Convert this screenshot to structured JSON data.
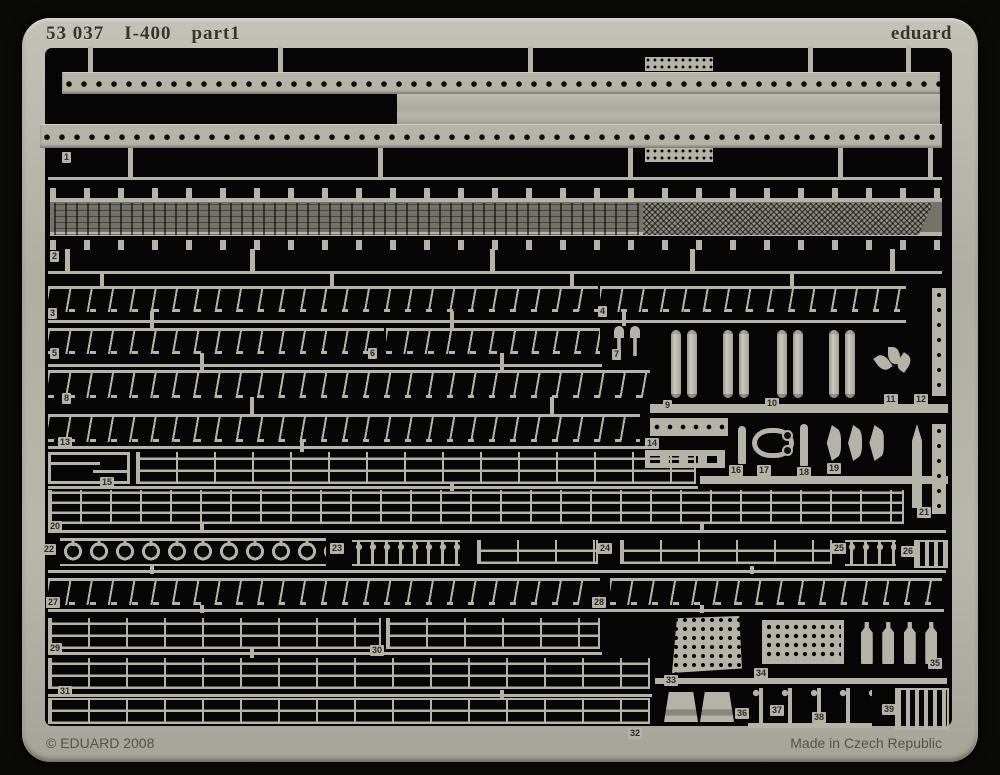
{
  "sheet": {
    "title_catalog": "53 037",
    "title_model": "I-400",
    "title_part": "part1",
    "brand": "eduard",
    "copyright": "© EDUARD 2008",
    "made_in": "Made in Czech Republic"
  },
  "colors": {
    "metal": "#b3b3a8",
    "background": "#060606",
    "deck": "#73736b",
    "label_text": "#2a2a25"
  },
  "part_labels": [
    {
      "n": "1",
      "x": 62,
      "y": 152
    },
    {
      "n": "2",
      "x": 50,
      "y": 251
    },
    {
      "n": "3",
      "x": 48,
      "y": 308
    },
    {
      "n": "4",
      "x": 598,
      "y": 306
    },
    {
      "n": "5",
      "x": 50,
      "y": 348
    },
    {
      "n": "6",
      "x": 368,
      "y": 348
    },
    {
      "n": "7",
      "x": 612,
      "y": 349
    },
    {
      "n": "8",
      "x": 62,
      "y": 393
    },
    {
      "n": "9",
      "x": 663,
      "y": 400
    },
    {
      "n": "10",
      "x": 765,
      "y": 398
    },
    {
      "n": "11",
      "x": 884,
      "y": 394
    },
    {
      "n": "12",
      "x": 914,
      "y": 394
    },
    {
      "n": "13",
      "x": 58,
      "y": 437
    },
    {
      "n": "14",
      "x": 645,
      "y": 438
    },
    {
      "n": "15",
      "x": 100,
      "y": 477
    },
    {
      "n": "16",
      "x": 729,
      "y": 465
    },
    {
      "n": "17",
      "x": 757,
      "y": 465
    },
    {
      "n": "18",
      "x": 797,
      "y": 467
    },
    {
      "n": "19",
      "x": 827,
      "y": 463
    },
    {
      "n": "20",
      "x": 48,
      "y": 521
    },
    {
      "n": "21",
      "x": 917,
      "y": 507
    },
    {
      "n": "22",
      "x": 42,
      "y": 544
    },
    {
      "n": "23",
      "x": 330,
      "y": 543
    },
    {
      "n": "24",
      "x": 598,
      "y": 543
    },
    {
      "n": "25",
      "x": 832,
      "y": 543
    },
    {
      "n": "26",
      "x": 901,
      "y": 546
    },
    {
      "n": "27",
      "x": 46,
      "y": 597
    },
    {
      "n": "28",
      "x": 592,
      "y": 597
    },
    {
      "n": "29",
      "x": 48,
      "y": 643
    },
    {
      "n": "30",
      "x": 370,
      "y": 645
    },
    {
      "n": "31",
      "x": 58,
      "y": 686
    },
    {
      "n": "32",
      "x": 628,
      "y": 728
    },
    {
      "n": "33",
      "x": 664,
      "y": 675
    },
    {
      "n": "34",
      "x": 754,
      "y": 668
    },
    {
      "n": "35",
      "x": 928,
      "y": 658
    },
    {
      "n": "36",
      "x": 735,
      "y": 708
    },
    {
      "n": "37",
      "x": 770,
      "y": 705
    },
    {
      "n": "38",
      "x": 812,
      "y": 712
    },
    {
      "n": "39",
      "x": 882,
      "y": 704
    }
  ],
  "strips": [
    {
      "t": "dotted",
      "x": 62,
      "y": 72,
      "w": 878,
      "h": 22,
      "n": "1"
    },
    {
      "t": "slab",
      "x": 397,
      "y": 94,
      "w": 543,
      "h": 31,
      "n": "1"
    },
    {
      "t": "dotted",
      "x": 40,
      "y": 124,
      "w": 902,
      "h": 24,
      "n": "1"
    },
    {
      "t": "minigrid",
      "x": 645,
      "y": 57,
      "w": 68,
      "h": 14,
      "n": "1"
    },
    {
      "t": "minigrid",
      "x": 645,
      "y": 148,
      "w": 68,
      "h": 14,
      "n": "1"
    },
    {
      "t": "deck",
      "x": 50,
      "y": 188,
      "w": 892,
      "h": 62,
      "n": "2"
    },
    {
      "t": "railing",
      "x": 48,
      "y": 286,
      "w": 550,
      "h": 26,
      "n": "3"
    },
    {
      "t": "railing",
      "x": 600,
      "y": 286,
      "w": 306,
      "h": 26,
      "n": "4"
    },
    {
      "t": "railing",
      "x": 48,
      "y": 328,
      "w": 336,
      "h": 26,
      "n": "5"
    },
    {
      "t": "railing",
      "x": 386,
      "y": 328,
      "w": 214,
      "h": 26,
      "n": "6"
    },
    {
      "t": "pins2",
      "x": 610,
      "y": 326,
      "w": 34,
      "h": 30,
      "n": "7"
    },
    {
      "t": "railing",
      "x": 48,
      "y": 370,
      "w": 602,
      "h": 28,
      "n": "8"
    },
    {
      "t": "torppair",
      "x": 664,
      "y": 328,
      "w": 40,
      "h": 72,
      "n": "9"
    },
    {
      "t": "torppair",
      "x": 716,
      "y": 328,
      "w": 40,
      "h": 72,
      "n": "9"
    },
    {
      "t": "torppair",
      "x": 770,
      "y": 328,
      "w": 40,
      "h": 72,
      "n": "10"
    },
    {
      "t": "torppair",
      "x": 822,
      "y": 328,
      "w": 40,
      "h": 72,
      "n": "10"
    },
    {
      "t": "sprig",
      "x": 876,
      "y": 346,
      "w": 36,
      "h": 46,
      "n": "11"
    },
    {
      "t": "vstrip",
      "x": 932,
      "y": 288,
      "w": 14,
      "h": 108,
      "n": "12"
    },
    {
      "t": "railing",
      "x": 48,
      "y": 414,
      "w": 592,
      "h": 28,
      "n": "13"
    },
    {
      "t": "beadstrip",
      "x": 650,
      "y": 418,
      "w": 78,
      "h": 18,
      "n": "14"
    },
    {
      "t": "slotstrip",
      "x": 645,
      "y": 450,
      "w": 80,
      "h": 18,
      "n": "14"
    },
    {
      "t": "bracket15",
      "x": 48,
      "y": 452,
      "w": 82,
      "h": 32,
      "n": "15"
    },
    {
      "t": "ladder2",
      "x": 136,
      "y": 452,
      "w": 560,
      "h": 32,
      "n": "15"
    },
    {
      "t": "pin",
      "x": 738,
      "y": 426,
      "w": 8,
      "h": 38,
      "n": "16"
    },
    {
      "t": "horseshoe",
      "x": 752,
      "y": 428,
      "w": 42,
      "h": 30,
      "n": "17"
    },
    {
      "t": "pin",
      "x": 800,
      "y": 424,
      "w": 8,
      "h": 42,
      "n": "18"
    },
    {
      "t": "crescents",
      "x": 820,
      "y": 424,
      "w": 68,
      "h": 38,
      "n": "19"
    },
    {
      "t": "ladder3",
      "x": 48,
      "y": 490,
      "w": 856,
      "h": 34,
      "n": "20"
    },
    {
      "t": "blade",
      "x": 912,
      "y": 424,
      "w": 10,
      "h": 84,
      "n": "21"
    },
    {
      "t": "vstrip",
      "x": 932,
      "y": 424,
      "w": 14,
      "h": 90,
      "n": "21"
    },
    {
      "t": "goblets",
      "x": 60,
      "y": 538,
      "w": 266,
      "h": 28,
      "n": "22"
    },
    {
      "t": "beadposts",
      "x": 352,
      "y": 540,
      "w": 108,
      "h": 26,
      "n": "23"
    },
    {
      "t": "ladder2",
      "x": 477,
      "y": 540,
      "w": 121,
      "h": 24,
      "n": "24"
    },
    {
      "t": "ladder2",
      "x": 620,
      "y": 540,
      "w": 212,
      "h": 24,
      "n": "24"
    },
    {
      "t": "beadposts",
      "x": 845,
      "y": 540,
      "w": 51,
      "h": 26,
      "n": "25"
    },
    {
      "t": "brackets",
      "x": 914,
      "y": 540,
      "w": 34,
      "h": 28,
      "n": "26"
    },
    {
      "t": "railing",
      "x": 48,
      "y": 578,
      "w": 552,
      "h": 27,
      "n": "27"
    },
    {
      "t": "railing",
      "x": 610,
      "y": 578,
      "w": 332,
      "h": 27,
      "n": "28"
    },
    {
      "t": "ladder2",
      "x": 48,
      "y": 618,
      "w": 333,
      "h": 31,
      "n": "29"
    },
    {
      "t": "ladder2",
      "x": 386,
      "y": 618,
      "w": 214,
      "h": 31,
      "n": "30"
    },
    {
      "t": "ladder2",
      "x": 48,
      "y": 658,
      "w": 602,
      "h": 31,
      "n": "31"
    },
    {
      "t": "ladder2",
      "x": 48,
      "y": 698,
      "w": 602,
      "h": 26,
      "n": "32"
    },
    {
      "t": "grid-trap",
      "x": 672,
      "y": 616,
      "w": 70,
      "h": 57,
      "n": "33"
    },
    {
      "t": "grid",
      "x": 762,
      "y": 620,
      "w": 82,
      "h": 44,
      "n": "34"
    },
    {
      "t": "pins4",
      "x": 852,
      "y": 614,
      "w": 94,
      "h": 52,
      "n": "35"
    },
    {
      "t": "funnels",
      "x": 662,
      "y": 692,
      "w": 74,
      "h": 30,
      "n": "36"
    },
    {
      "t": "posts",
      "x": 748,
      "y": 688,
      "w": 124,
      "h": 40,
      "n": "37"
    },
    {
      "t": "brackets",
      "x": 895,
      "y": 688,
      "w": 54,
      "h": 42,
      "n": "39"
    }
  ],
  "runners": [
    {
      "x": 48,
      "y": 177,
      "w": 894,
      "h": 3
    },
    {
      "x": 48,
      "y": 271,
      "w": 894,
      "h": 3
    },
    {
      "x": 48,
      "y": 320,
      "w": 858,
      "h": 3
    },
    {
      "x": 48,
      "y": 364,
      "w": 554,
      "h": 3
    },
    {
      "x": 650,
      "y": 404,
      "w": 298,
      "h": 9
    },
    {
      "x": 48,
      "y": 446,
      "w": 600,
      "h": 3
    },
    {
      "x": 48,
      "y": 486,
      "w": 650,
      "h": 3
    },
    {
      "x": 700,
      "y": 476,
      "w": 248,
      "h": 8
    },
    {
      "x": 48,
      "y": 530,
      "w": 898,
      "h": 3
    },
    {
      "x": 48,
      "y": 570,
      "w": 898,
      "h": 3
    },
    {
      "x": 48,
      "y": 609,
      "w": 896,
      "h": 3
    },
    {
      "x": 48,
      "y": 652,
      "w": 554,
      "h": 3
    },
    {
      "x": 48,
      "y": 694,
      "w": 604,
      "h": 3
    },
    {
      "x": 655,
      "y": 678,
      "w": 292,
      "h": 6
    }
  ],
  "tabs": [
    {
      "x": 88,
      "y": 46,
      "w": 5,
      "h": 27
    },
    {
      "x": 278,
      "y": 46,
      "w": 5,
      "h": 27
    },
    {
      "x": 528,
      "y": 46,
      "w": 5,
      "h": 27
    },
    {
      "x": 808,
      "y": 46,
      "w": 5,
      "h": 27
    },
    {
      "x": 906,
      "y": 46,
      "w": 5,
      "h": 27
    },
    {
      "x": 128,
      "y": 146,
      "w": 5,
      "h": 31
    },
    {
      "x": 378,
      "y": 146,
      "w": 5,
      "h": 31
    },
    {
      "x": 628,
      "y": 146,
      "w": 5,
      "h": 31
    },
    {
      "x": 838,
      "y": 146,
      "w": 5,
      "h": 31
    },
    {
      "x": 928,
      "y": 146,
      "w": 5,
      "h": 31
    },
    {
      "x": 65,
      "y": 249,
      "w": 5,
      "h": 22
    },
    {
      "x": 250,
      "y": 249,
      "w": 5,
      "h": 22
    },
    {
      "x": 490,
      "y": 249,
      "w": 5,
      "h": 22
    },
    {
      "x": 690,
      "y": 249,
      "w": 5,
      "h": 22
    },
    {
      "x": 890,
      "y": 249,
      "w": 5,
      "h": 22
    },
    {
      "x": 100,
      "y": 273,
      "w": 4,
      "h": 13
    },
    {
      "x": 330,
      "y": 273,
      "w": 4,
      "h": 13
    },
    {
      "x": 570,
      "y": 273,
      "w": 4,
      "h": 13
    },
    {
      "x": 790,
      "y": 273,
      "w": 4,
      "h": 13
    },
    {
      "x": 150,
      "y": 311,
      "w": 4,
      "h": 17
    },
    {
      "x": 450,
      "y": 311,
      "w": 4,
      "h": 17
    },
    {
      "x": 622,
      "y": 311,
      "w": 4,
      "h": 15
    },
    {
      "x": 200,
      "y": 353,
      "w": 4,
      "h": 17
    },
    {
      "x": 500,
      "y": 353,
      "w": 4,
      "h": 17
    },
    {
      "x": 250,
      "y": 397,
      "w": 4,
      "h": 17
    },
    {
      "x": 550,
      "y": 397,
      "w": 4,
      "h": 17
    },
    {
      "x": 300,
      "y": 441,
      "w": 4,
      "h": 11
    },
    {
      "x": 450,
      "y": 483,
      "w": 4,
      "h": 8
    },
    {
      "x": 200,
      "y": 524,
      "w": 4,
      "h": 8
    },
    {
      "x": 700,
      "y": 524,
      "w": 4,
      "h": 8
    },
    {
      "x": 150,
      "y": 566,
      "w": 4,
      "h": 8
    },
    {
      "x": 750,
      "y": 566,
      "w": 4,
      "h": 8
    },
    {
      "x": 200,
      "y": 605,
      "w": 4,
      "h": 8
    },
    {
      "x": 700,
      "y": 605,
      "w": 4,
      "h": 8
    },
    {
      "x": 250,
      "y": 649,
      "w": 4,
      "h": 9
    },
    {
      "x": 500,
      "y": 690,
      "w": 4,
      "h": 8
    }
  ]
}
